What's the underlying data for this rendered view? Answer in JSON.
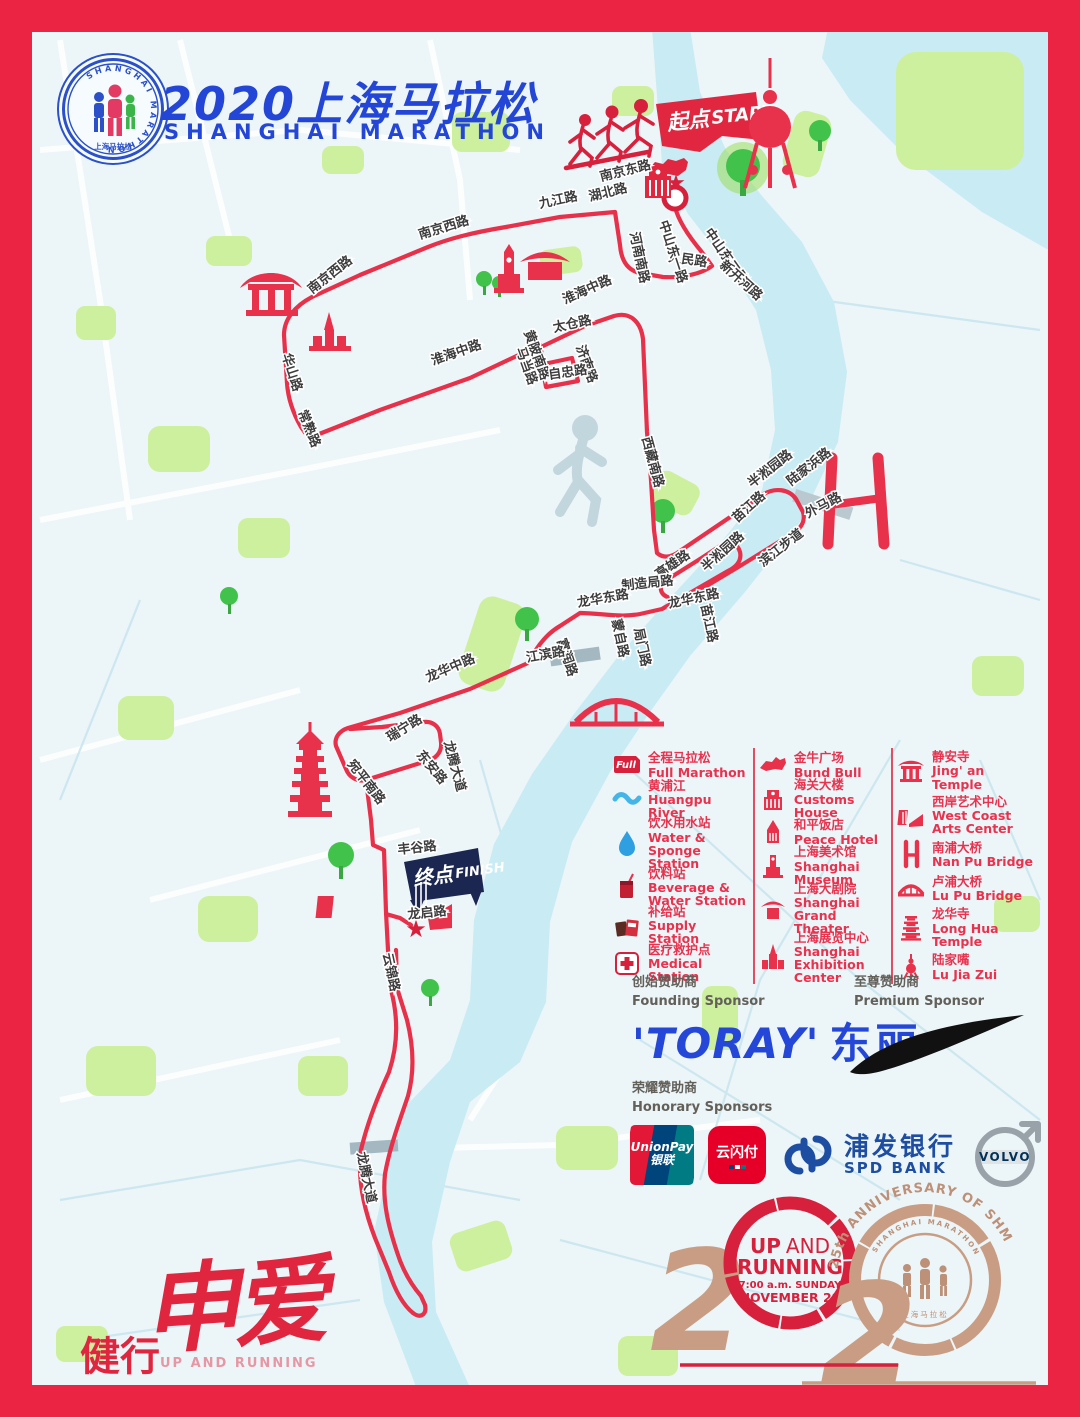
{
  "header": {
    "title_zh": "2020上海马拉松",
    "title_en": "SHANGHAI MARATHON",
    "badge_arc": "SHANGHAI MARATHON",
    "badge_bottom": "上海马拉松"
  },
  "map": {
    "start": {
      "zh": "起点",
      "en": "START"
    },
    "finish": {
      "zh": "终点",
      "en": "FINISH"
    },
    "street_labels": [
      {
        "text": "南京东路",
        "x": 601,
        "y": 181,
        "r": -14
      },
      {
        "text": "湖北路",
        "x": 590,
        "y": 201,
        "r": -14
      },
      {
        "text": "九江路",
        "x": 540,
        "y": 208,
        "r": -12
      },
      {
        "text": "河南南路",
        "x": 630,
        "y": 233,
        "r": 78
      },
      {
        "text": "人民路",
        "x": 668,
        "y": 261,
        "r": 8
      },
      {
        "text": "中山东一路",
        "x": 659,
        "y": 222,
        "r": 72
      },
      {
        "text": "中山东二路",
        "x": 704,
        "y": 232,
        "r": 55
      },
      {
        "text": "新开河路",
        "x": 719,
        "y": 266,
        "r": 42
      },
      {
        "text": "南京西路",
        "x": 420,
        "y": 239,
        "r": -17
      },
      {
        "text": "南京西路",
        "x": 312,
        "y": 294,
        "r": -38
      },
      {
        "text": "华山路",
        "x": 282,
        "y": 355,
        "r": 72
      },
      {
        "text": "常熟路",
        "x": 298,
        "y": 412,
        "r": 68
      },
      {
        "text": "淮海中路",
        "x": 433,
        "y": 365,
        "r": -19
      },
      {
        "text": "淮海中路",
        "x": 565,
        "y": 304,
        "r": -24
      },
      {
        "text": "黄陂南路",
        "x": 524,
        "y": 332,
        "r": 70
      },
      {
        "text": "太仓路",
        "x": 554,
        "y": 332,
        "r": -12
      },
      {
        "text": "马当路",
        "x": 516,
        "y": 349,
        "r": 70
      },
      {
        "text": "济南路",
        "x": 576,
        "y": 347,
        "r": 70
      },
      {
        "text": "自忠路",
        "x": 549,
        "y": 379,
        "r": -8
      },
      {
        "text": "西藏南路",
        "x": 642,
        "y": 438,
        "r": 75
      },
      {
        "text": "半淞园路",
        "x": 752,
        "y": 488,
        "r": -38
      },
      {
        "text": "陆家浜路",
        "x": 791,
        "y": 486,
        "r": -38
      },
      {
        "text": "外马路",
        "x": 808,
        "y": 518,
        "r": -28
      },
      {
        "text": "苗江路",
        "x": 737,
        "y": 523,
        "r": -42
      },
      {
        "text": "滨江步道",
        "x": 763,
        "y": 567,
        "r": -38
      },
      {
        "text": "半淞园路",
        "x": 706,
        "y": 572,
        "r": -42
      },
      {
        "text": "高雄路",
        "x": 659,
        "y": 579,
        "r": -35
      },
      {
        "text": "制造局路",
        "x": 622,
        "y": 590,
        "r": -6
      },
      {
        "text": "龙华东路",
        "x": 578,
        "y": 607,
        "r": -10
      },
      {
        "text": "蒙自路",
        "x": 612,
        "y": 620,
        "r": 78
      },
      {
        "text": "局门路",
        "x": 634,
        "y": 629,
        "r": 78
      },
      {
        "text": "龙华东路",
        "x": 669,
        "y": 608,
        "r": -12
      },
      {
        "text": "苗江路",
        "x": 701,
        "y": 605,
        "r": 78
      },
      {
        "text": "富润路",
        "x": 557,
        "y": 640,
        "r": 72
      },
      {
        "text": "江滨路",
        "x": 527,
        "y": 662,
        "r": -10
      },
      {
        "text": "龙华中路",
        "x": 428,
        "y": 682,
        "r": -23
      },
      {
        "text": "瑞宁路",
        "x": 390,
        "y": 742,
        "r": -32
      },
      {
        "text": "东安路",
        "x": 416,
        "y": 755,
        "r": 50
      },
      {
        "text": "龙腾大道",
        "x": 444,
        "y": 742,
        "r": 75
      },
      {
        "text": "宛平南路",
        "x": 347,
        "y": 764,
        "r": 52
      },
      {
        "text": "丰谷路",
        "x": 398,
        "y": 854,
        "r": -6
      },
      {
        "text": "龙启路",
        "x": 408,
        "y": 919,
        "r": -6
      },
      {
        "text": "云锦路",
        "x": 383,
        "y": 954,
        "r": 78
      },
      {
        "text": "龙腾大道",
        "x": 357,
        "y": 1153,
        "r": 78
      }
    ]
  },
  "legend": {
    "col1": [
      {
        "icon": "full-flag",
        "badge": "Full",
        "zh": "全程马拉松",
        "en": "Full Marathon"
      },
      {
        "icon": "river",
        "zh": "黄浦江",
        "en": "Huangpu River"
      },
      {
        "icon": "water-drop",
        "zh": "饮水用水站",
        "en": "Water & Sponge Station"
      },
      {
        "icon": "beverage",
        "zh": "饮料站",
        "en": "Beverage & Water Station"
      },
      {
        "icon": "supply",
        "zh": "补给站",
        "en": "Supply Station"
      },
      {
        "icon": "medical",
        "zh": "医疗救护点",
        "en": "Medical Station"
      }
    ],
    "col2": [
      {
        "icon": "bund-bull",
        "zh": "金牛广场",
        "en": "Bund Bull"
      },
      {
        "icon": "customs-house",
        "zh": "海关大楼",
        "en": "Customs House"
      },
      {
        "icon": "peace-hotel",
        "zh": "和平饭店",
        "en": "Peace Hotel"
      },
      {
        "icon": "shanghai-museum",
        "zh": "上海美术馆",
        "en": "Shanghai Museum"
      },
      {
        "icon": "grand-theater",
        "zh": "上海大剧院",
        "en": "Shanghai Grand Theater"
      },
      {
        "icon": "exhibition-center",
        "zh": "上海展览中心",
        "en": "Shanghai Exhibition Center"
      }
    ],
    "col3": [
      {
        "icon": "jingan-temple",
        "zh": "静安寺",
        "en": "Jing' an Temple"
      },
      {
        "icon": "west-coast",
        "zh": "西岸艺术中心",
        "en": "West Coast Arts Center"
      },
      {
        "icon": "nanpu-bridge",
        "zh": "南浦大桥",
        "en": "Nan Pu Bridge"
      },
      {
        "icon": "lupu-bridge",
        "zh": "卢浦大桥",
        "en": "Lu Pu Bridge"
      },
      {
        "icon": "longhua-temple",
        "zh": "龙华寺",
        "en": "Long Hua Temple"
      },
      {
        "icon": "lujiazui",
        "zh": "陆家嘴",
        "en": "Lu Jia Zui"
      }
    ]
  },
  "sponsors": {
    "founding": {
      "label_zh": "创始赞助商",
      "label_en": "Founding Sponsor",
      "name_en": "'TORAY'",
      "name_cn": "东丽"
    },
    "premium": {
      "label_zh": "至尊赞助商",
      "label_en": "Premium Sponsor",
      "name": "Nike"
    },
    "honorary": {
      "label_zh": "荣耀赞助商",
      "label_en": "Honorary Sponsors",
      "unionpay_en": "UnionPay",
      "unionpay_cn": "银联",
      "quickpass": "云闪付",
      "spd_cn": "浦发银行",
      "spd_en": "SPD BANK",
      "volvo": "VOLVO"
    }
  },
  "emblem": {
    "digit2": "2",
    "digit2b": "2",
    "up": "UP",
    "and": "AND",
    "running": "RUNNING",
    "time": "7:00 a.m. SUNDAY",
    "date": "NOVEMBER 29",
    "arc": "25th ANNIVERSARY OF SHM",
    "seal_arc": "SHANGHAI MARATHON",
    "seal_bottom": "上海马拉松"
  },
  "slogan": {
    "left": "健行",
    "main": "申爱",
    "watermark": "UP AND RUNNING",
    "bottom": "活力重燃"
  }
}
